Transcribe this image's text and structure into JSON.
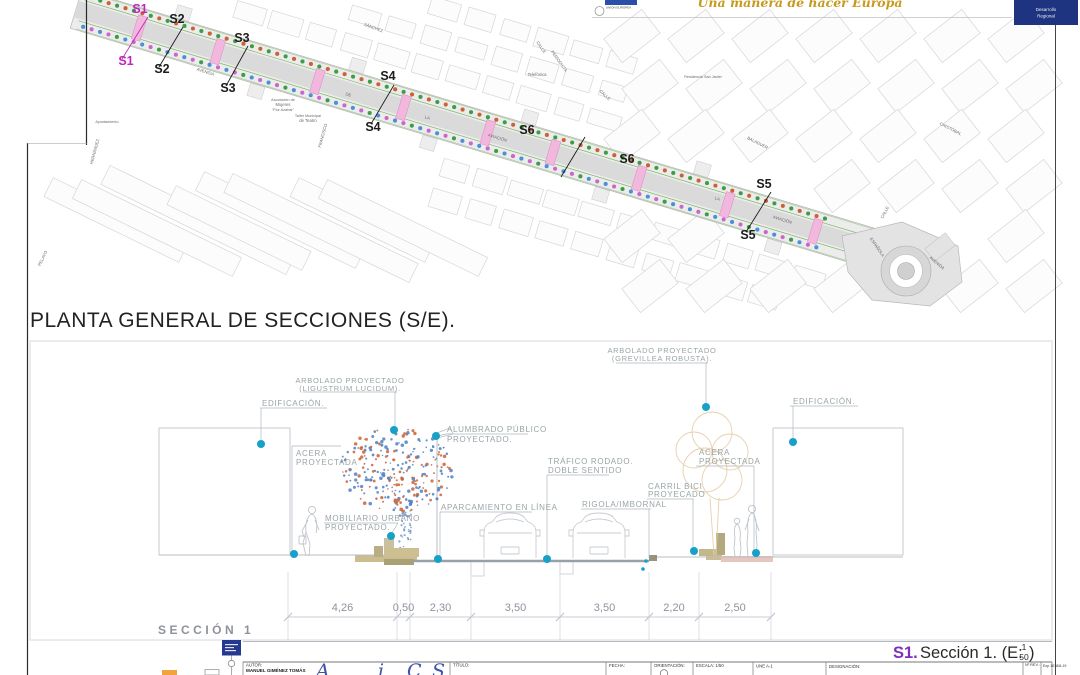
{
  "header": {
    "eu_motto": "Una manera de hacer Europa",
    "eu_label": "UNIÓN EUROPEA",
    "box_line1": "Desarrollo",
    "box_line2": "Regional"
  },
  "plan": {
    "title": "PLANTA GENERAL DE SECCIONES (S/E).",
    "section_markers": [
      {
        "id": "S1",
        "color": "#c024c0",
        "labels": [
          [
            140,
            13
          ],
          [
            126,
            65
          ]
        ],
        "line": [
          148,
          17,
          122,
          59
        ]
      },
      {
        "id": "S2",
        "color": "#1c1c1c",
        "labels": [
          [
            177,
            23
          ],
          [
            162,
            73
          ]
        ],
        "line": [
          183,
          27,
          159,
          67
        ]
      },
      {
        "id": "S3",
        "color": "#1c1c1c",
        "labels": [
          [
            242,
            42
          ],
          [
            228,
            92
          ]
        ],
        "line": [
          248,
          46,
          226,
          86
        ]
      },
      {
        "id": "S4",
        "color": "#1c1c1c",
        "labels": [
          [
            388,
            80
          ],
          [
            373,
            131
          ]
        ],
        "line": [
          394,
          85,
          371,
          124
        ]
      },
      {
        "id": "S6",
        "color": "#1c1c1c",
        "labels": [
          [
            527,
            134
          ],
          [
            627,
            163
          ]
        ],
        "line": [
          585,
          137,
          561,
          177
        ]
      },
      {
        "id": "S5",
        "color": "#1c1c1c",
        "labels": [
          [
            764,
            188
          ],
          [
            748,
            239
          ]
        ],
        "line": [
          771,
          192,
          746,
          232
        ]
      }
    ],
    "street_labels": [
      {
        "t": "AVENIDA",
        "x": 205,
        "y": 73,
        "r": 17
      },
      {
        "t": "DE",
        "x": 348,
        "y": 96,
        "r": 17
      },
      {
        "t": "LA",
        "x": 427,
        "y": 119,
        "r": 17
      },
      {
        "t": "AVIACIÓN",
        "x": 497,
        "y": 139,
        "r": 17
      },
      {
        "t": "LA",
        "x": 717,
        "y": 200,
        "r": 17
      },
      {
        "t": "AVIACIÓN",
        "x": 782,
        "y": 221,
        "r": 17
      },
      {
        "t": "ESPAÑOLA",
        "x": 876,
        "y": 248,
        "r": 55
      },
      {
        "t": "AVENIDA",
        "x": 936,
        "y": 264,
        "r": 40
      },
      {
        "t": "CALLE",
        "x": 540,
        "y": 48,
        "r": 55
      },
      {
        "t": "PERIODISTA",
        "x": 558,
        "y": 62,
        "r": 55
      },
      {
        "t": "CALLE",
        "x": 604,
        "y": 96,
        "r": 42
      },
      {
        "t": "CALLE",
        "x": 886,
        "y": 213,
        "r": -62
      },
      {
        "t": "FRANCISCO",
        "x": 324,
        "y": 136,
        "r": -75
      },
      {
        "t": "BALAGUER",
        "x": 757,
        "y": 144,
        "r": 27
      },
      {
        "t": "CRISTÓBAL",
        "x": 950,
        "y": 130,
        "r": 27
      },
      {
        "t": "SÁNCHEZ",
        "x": 373,
        "y": 29,
        "r": 20
      },
      {
        "t": "PELAYO",
        "x": 44,
        "y": 259,
        "r": -64
      },
      {
        "t": "HERNÁNDEZ",
        "x": 96,
        "y": 152,
        "r": -75
      },
      {
        "t": "Telefónica",
        "x": 537,
        "y": 76,
        "r": 0
      },
      {
        "t": "Residencia San Javier",
        "x": 703,
        "y": 78,
        "r": 0
      },
      {
        "t": "Ayuntamiento",
        "x": 107,
        "y": 123,
        "r": 0
      },
      {
        "t": "Asociación de",
        "x": 283,
        "y": 101,
        "r": 0
      },
      {
        "t": "Mujeres",
        "x": 283,
        "y": 106,
        "r": 0
      },
      {
        "t": "\"Flor Azahar\"",
        "x": 283,
        "y": 111,
        "r": 0
      },
      {
        "t": "Taller Municipal",
        "x": 308,
        "y": 117,
        "r": 0
      },
      {
        "t": "de Teatro",
        "x": 308,
        "y": 122,
        "r": 0
      }
    ]
  },
  "section": {
    "name_label": "SECCIÓN 1",
    "labels": {
      "edificacion_left": "EDIFICACIÓN.",
      "arbolado_left1": "ARBOLADO PROYECTADO",
      "arbolado_left2": "(LIGUSTRUM LUCIDUM).",
      "acera_left1": "ACERA",
      "acera_left2": "PROYECTADA",
      "alumbrado1": "ALUMBRADO PÚBLICO",
      "alumbrado2": "PROYECTADO.",
      "mobiliario1": "MOBILIARIO URBANO",
      "mobiliario2": "PROYECTADO.",
      "aparcamiento": "APARCAMIENTO EN LÍNEA",
      "trafico1": "TRÁFICO RODADO.",
      "trafico2": "DOBLE SENTIDO",
      "rigola": "RIGOLA/IMBORNAL",
      "carril1": "CARRIL BICI",
      "carril2": "PROYECADO",
      "acera_right1": "ACERA",
      "acera_right2": "PROYECTADA",
      "arbolado_right1": "ARBOLADO PROYECTADO",
      "arbolado_right2": "(GREVILLEA ROBUSTA).",
      "edificacion_right": "EDIFICACIÓN."
    },
    "dimensions": {
      "values": [
        "4,26",
        "0,50",
        "2,30",
        "3,50",
        "3,50",
        "2,20",
        "2,50"
      ],
      "boundaries_px": [
        288,
        397,
        410,
        471,
        560,
        649,
        699,
        771
      ]
    },
    "subtitle": {
      "s_ref": "S1.",
      "main": "Sección 1. (E:",
      "frac_num": "1",
      "frac_den": "50",
      "close": ")"
    }
  },
  "titleblock": {
    "autor_label": "AUTOR:",
    "autor_name": "MANUEL GIMÉNEZ TOMÁS",
    "logo_letters": [
      "A",
      "i",
      "C",
      "S"
    ],
    "titulo_label": "TÍTULO:",
    "fecha_label": "FECHA:",
    "orientacion_label": "ORIENTACIÓN:",
    "escala_label": "ESCALA: 1/50",
    "formato_label": "UNE A-1",
    "designacion_label": "DESIGNACIÓN:",
    "nrev_label": "Nº REV.:",
    "exp_label": "Exp 1018/8-19"
  },
  "colors": {
    "marker_magenta": "#c024c0",
    "subtitle_purple": "#7e2fc0",
    "leader_dot": "#17a0c8",
    "tree_dot_orange": "#cd6136",
    "tree_dot_green": "#3d9c45",
    "tree_dot_blue": "#4a90d9",
    "tree_dot_pink": "#cc66cc",
    "foliage_blue": "#4d7fc4",
    "foliage_orange": "#cd6136",
    "crossing_pink": "#f2b7dd",
    "avenue_green_line": "#6fb254",
    "eu_navy": "#1e3480",
    "eu_gold": "#c79a1e",
    "label_gray": "#99a5a6"
  }
}
